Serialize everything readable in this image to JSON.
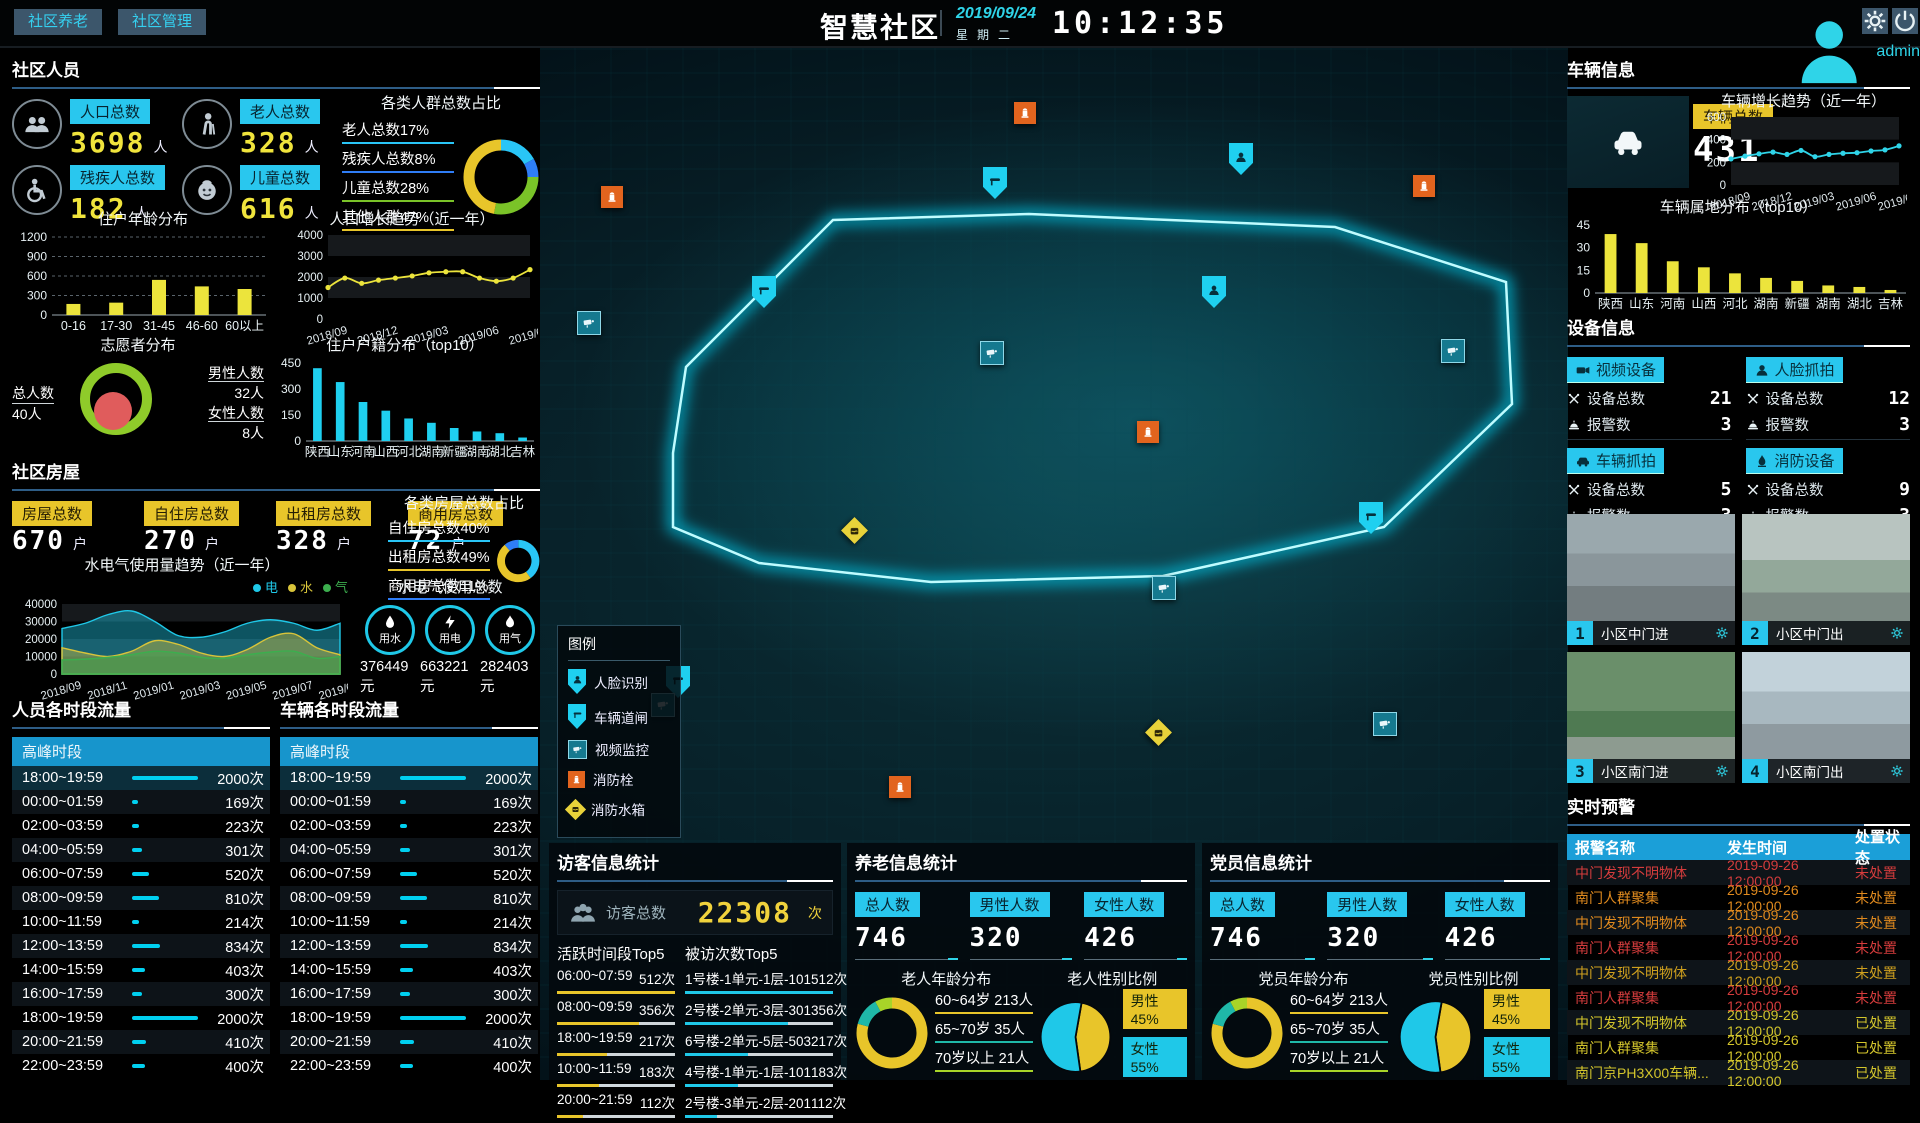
{
  "header": {
    "tabs": [
      {
        "label": "社区养老"
      },
      {
        "label": "社区管理"
      }
    ],
    "title": "智慧社区",
    "date": "2019/09/24",
    "weekday": "星期二",
    "time": "10:12:35",
    "user": "admin"
  },
  "accent": {
    "cyan": "#29c7ee",
    "yellow": "#e8c52a",
    "red": "#d43c3c",
    "orange": "#e08a1e"
  },
  "community_people": {
    "title": "社区人员",
    "unit": "人",
    "stats": [
      {
        "label": "人口总数",
        "value": "3698",
        "icon": "crowd"
      },
      {
        "label": "老人总数",
        "value": "328",
        "icon": "elder"
      },
      {
        "label": "残疾人总数",
        "value": "182",
        "icon": "wheelchair"
      },
      {
        "label": "儿童总数",
        "value": "616",
        "icon": "child"
      }
    ]
  },
  "house": {
    "title": "社区房屋",
    "unit": "户",
    "stats": [
      {
        "label": "房屋总数",
        "value": "670"
      },
      {
        "label": "自住房总数",
        "value": "270"
      },
      {
        "label": "出租房总数",
        "value": "328"
      },
      {
        "label": "商用房总数",
        "value": "72"
      }
    ],
    "util_total_title": "水电气使用总数",
    "util_totals": [
      {
        "label": "用水",
        "icon": "water",
        "value": "376449元"
      },
      {
        "label": "用电",
        "icon": "bolt",
        "value": "663221元"
      },
      {
        "label": "用气",
        "icon": "flame",
        "value": "282403元"
      }
    ]
  },
  "flows": {
    "people_title": "人员各时段流量",
    "vehicle_title": "车辆各时段流量",
    "header": "高峰时段",
    "unit": "次",
    "max": 2000,
    "rows": [
      {
        "time": "18:00~19:59",
        "count": 2000
      },
      {
        "time": "00:00~01:59",
        "count": 169
      },
      {
        "time": "02:00~03:59",
        "count": 223
      },
      {
        "time": "04:00~05:59",
        "count": 301
      },
      {
        "time": "06:00~07:59",
        "count": 520
      },
      {
        "time": "08:00~09:59",
        "count": 810
      },
      {
        "time": "10:00~11:59",
        "count": 214
      },
      {
        "time": "12:00~13:59",
        "count": 834
      },
      {
        "time": "14:00~15:59",
        "count": 403
      },
      {
        "time": "16:00~17:59",
        "count": 300
      },
      {
        "time": "18:00~19:59",
        "count": 2000
      },
      {
        "time": "20:00~21:59",
        "count": 410
      },
      {
        "time": "22:00~23:59",
        "count": 400
      }
    ]
  },
  "visitor": {
    "title": "访客信息统计",
    "total_label": "访客总数",
    "total_value": "22308",
    "total_unit": "次",
    "unit": "次",
    "active_title": "活跃时间段Top5",
    "active": [
      {
        "label": "06:00~07:59",
        "value": 512
      },
      {
        "label": "08:00~09:59",
        "value": 356
      },
      {
        "label": "18:00~19:59",
        "value": 217
      },
      {
        "label": "10:00~11:59",
        "value": 183
      },
      {
        "label": "20:00~21:59",
        "value": 112
      }
    ],
    "visited_title": "被访次数Top5",
    "visited": [
      {
        "label": "1号楼-1单元-1层-101",
        "value": 512
      },
      {
        "label": "2号楼-2单元-3层-301",
        "value": 356
      },
      {
        "label": "6号楼-2单元-5层-503",
        "value": 217
      },
      {
        "label": "4号楼-1单元-1层-101",
        "value": 183
      },
      {
        "label": "2号楼-3单元-2层-201",
        "value": 112
      }
    ]
  },
  "elderly": {
    "title": "养老信息统计",
    "stats": [
      {
        "label": "总人数",
        "value": "746"
      },
      {
        "label": "男性人数",
        "value": "320"
      },
      {
        "label": "女性人数",
        "value": "426"
      }
    ]
  },
  "party": {
    "title": "党员信息统计",
    "stats": [
      {
        "label": "总人数",
        "value": "746"
      },
      {
        "label": "男性人数",
        "value": "320"
      },
      {
        "label": "女性人数",
        "value": "426"
      }
    ]
  },
  "vehicle_info": {
    "title": "车辆信息",
    "badge": "车辆总数",
    "value": "431"
  },
  "devices": {
    "title": "设备信息",
    "total_label": "设备总数",
    "alarm_label": "报警数",
    "items": [
      {
        "label": "视频设备",
        "icon": "video",
        "total": "21",
        "alarms": "3"
      },
      {
        "label": "人脸抓拍",
        "icon": "faceb",
        "total": "12",
        "alarms": "3"
      },
      {
        "label": "车辆抓拍",
        "icon": "car",
        "total": "5",
        "alarms": "3"
      },
      {
        "label": "消防设备",
        "icon": "flame2",
        "total": "9",
        "alarms": "3"
      }
    ]
  },
  "cameras": {
    "items": [
      {
        "num": "1",
        "label": "小区中门进"
      },
      {
        "num": "2",
        "label": "小区中门出"
      },
      {
        "num": "3",
        "label": "小区南门进"
      },
      {
        "num": "4",
        "label": "小区南门出"
      }
    ]
  },
  "alerts": {
    "title": "实时预警",
    "headers": [
      "报警名称",
      "发生时间",
      "处置状态"
    ],
    "rows": [
      {
        "name": "中门发现不明物体",
        "time": "2019-09-26 12:00:00",
        "status": "未处置",
        "color": "#d43c3c"
      },
      {
        "name": "南门人群聚集",
        "time": "2019-09-26 12:00:00",
        "status": "未处置",
        "color": "#e08a1e"
      },
      {
        "name": "中门发现不明物体",
        "time": "2019-09-26 12:00:00",
        "status": "未处置",
        "color": "#e08a1e"
      },
      {
        "name": "南门人群聚集",
        "time": "2019-09-26 12:00:00",
        "status": "未处置",
        "color": "#d43c3c"
      },
      {
        "name": "中门发现不明物体",
        "time": "2019-09-26 12:00:00",
        "status": "未处置",
        "color": "#cfa01e"
      },
      {
        "name": "南门人群聚集",
        "time": "2019-09-26 12:00:00",
        "status": "未处置",
        "color": "#d43c3c"
      },
      {
        "name": "中门发现不明物体",
        "time": "2019-09-26 12:00:00",
        "status": "已处置",
        "color": "#d3c52c"
      },
      {
        "name": "南门人群聚集",
        "time": "2019-09-26 12:00:00",
        "status": "已处置",
        "color": "#d3c52c"
      },
      {
        "name": "南门京PH3X00车辆...",
        "time": "2019-09-26 12:00:00",
        "status": "已处置",
        "color": "#d3c52c"
      }
    ]
  },
  "map": {
    "legend_title": "图例",
    "legend": [
      {
        "type": "face",
        "label": "人脸识别"
      },
      {
        "type": "gate",
        "label": "车辆道闸"
      },
      {
        "type": "video",
        "label": "视频监控"
      },
      {
        "type": "hydrant",
        "label": "消防栓"
      },
      {
        "type": "tank",
        "label": "消防水箱"
      }
    ],
    "markers": [
      {
        "type": "hydrant",
        "x": 72,
        "y": 154
      },
      {
        "type": "video",
        "x": 48,
        "y": 279
      },
      {
        "type": "gate",
        "x": 223,
        "y": 244
      },
      {
        "type": "hydrant",
        "x": 485,
        "y": 70
      },
      {
        "type": "gate",
        "x": 454,
        "y": 135
      },
      {
        "type": "face",
        "x": 700,
        "y": 111
      },
      {
        "type": "hydrant",
        "x": 884,
        "y": 143
      },
      {
        "type": "face",
        "x": 673,
        "y": 244
      },
      {
        "type": "video",
        "x": 451,
        "y": 309
      },
      {
        "type": "video",
        "x": 912,
        "y": 307
      },
      {
        "type": "hydrant",
        "x": 608,
        "y": 389
      },
      {
        "type": "tank",
        "x": 316,
        "y": 489
      },
      {
        "type": "gate",
        "x": 830,
        "y": 470
      },
      {
        "type": "video",
        "x": 623,
        "y": 544
      },
      {
        "type": "gate",
        "x": 137,
        "y": 634
      },
      {
        "type": "video",
        "x": 122,
        "y": 661
      },
      {
        "type": "tank",
        "x": 620,
        "y": 691
      },
      {
        "type": "hydrant",
        "x": 360,
        "y": 744
      },
      {
        "type": "video",
        "x": 844,
        "y": 680
      }
    ],
    "boundary": "133,407 146,321 293,174 489,168 795,181 966,236 972,358 844,481 623,530 391,536 219,517 133,481"
  },
  "charts": {
    "crowd_ratio": {
      "type": "donut",
      "title": "各类人群总数占比",
      "items": [
        {
          "label": "老人总数17%",
          "value": 17,
          "color": "#29c5f6"
        },
        {
          "label": "残疾人总数8%",
          "value": 8,
          "color": "#2f7df6"
        },
        {
          "label": "儿童总数28%",
          "value": 28,
          "color": "#7ac328"
        },
        {
          "label": "其他人群47%",
          "value": 47,
          "color": "#e8c52a"
        }
      ]
    },
    "age_dist": {
      "type": "bar",
      "title": "住户年龄分布",
      "grid": "dash",
      "mL": 40,
      "categories": [
        "0-16",
        "17-30",
        "31-45",
        "46-60",
        "60以上"
      ],
      "values": [
        170,
        190,
        540,
        440,
        400
      ],
      "ticks": [
        0,
        300,
        600,
        900,
        1200
      ],
      "ymax": 1200,
      "color": "#ece43c"
    },
    "pop_growth": {
      "type": "line",
      "title": "人口增长趋势（近一年）",
      "mL": 44,
      "x_labels": [
        "2018/09",
        "",
        "",
        "2018/12",
        "",
        "",
        "2019/03",
        "",
        "",
        "2019/06",
        "",
        "",
        "2019/09"
      ],
      "values": [
        1500,
        1950,
        1700,
        1850,
        1950,
        2050,
        2200,
        2250,
        2250,
        1950,
        1800,
        1950,
        2350
      ],
      "ticks": [
        0,
        1000,
        2000,
        3000,
        4000
      ],
      "ymax": 4000,
      "color": "#ece43c"
    },
    "volunteer": {
      "type": "rings",
      "title": "志愿者分布",
      "total_label": "总人数",
      "total": "40人",
      "male_label": "男性人数",
      "male": "32人",
      "female_label": "女性人数",
      "female": "8人",
      "ring_color": "#8fcb2a",
      "inner_color": "#e05c5c"
    },
    "hukou": {
      "type": "bar",
      "title": "住户户籍分布（top10）",
      "mL": 36,
      "categories": [
        "陕西",
        "山东",
        "河南",
        "山西",
        "河北",
        "湖南",
        "新疆",
        "湖南",
        "湖北",
        "吉林"
      ],
      "values": [
        420,
        340,
        225,
        175,
        130,
        105,
        75,
        55,
        45,
        20
      ],
      "ticks": [
        0,
        150,
        300,
        450
      ],
      "ymax": 450,
      "color": "#1fd0f0"
    },
    "house_ratio": {
      "type": "donut",
      "title": "各类房屋总数占比",
      "items": [
        {
          "label": "自住房总数40%",
          "value": 40,
          "color": "#29c5f6"
        },
        {
          "label": "出租房总数49%",
          "value": 49,
          "color": "#e8c52a"
        },
        {
          "label": "商用房总数11%",
          "value": 11,
          "color": "#2f7df6"
        }
      ]
    },
    "utilities": {
      "type": "area",
      "title": "水电气使用量趋势（近一年）",
      "mL": 50,
      "x_labels": [
        "2018/09",
        "",
        "2018/11",
        "",
        "2019/01",
        "",
        "2019/03",
        "",
        "2019/05",
        "",
        "2019/07",
        "",
        "2019/09"
      ],
      "series": [
        {
          "name": "电",
          "color": "#1fc8e8",
          "values": [
            26000,
            29000,
            34000,
            36000,
            30000,
            22000,
            21000,
            24000,
            29000,
            31000,
            29000,
            25000,
            29000
          ]
        },
        {
          "name": "水",
          "color": "#d8c43a",
          "values": [
            15000,
            12000,
            10000,
            13000,
            19000,
            17000,
            12000,
            10000,
            14000,
            21000,
            23000,
            15000,
            11000
          ]
        },
        {
          "name": "气",
          "color": "#3cae4e",
          "values": [
            8000,
            8500,
            9500,
            11000,
            13000,
            12000,
            9500,
            9000,
            11000,
            12500,
            13000,
            9000,
            10000
          ]
        }
      ],
      "ticks": [
        0,
        10000,
        20000,
        30000,
        40000
      ],
      "ymax": 40000
    },
    "veh_growth": {
      "type": "line",
      "title": "车辆增长趋势（近一年）",
      "mL": 34,
      "x_labels": [
        "2018/09",
        "",
        "",
        "2018/12",
        "",
        "",
        "2019/03",
        "",
        "",
        "2019/06",
        "",
        "",
        "2019/09"
      ],
      "values": [
        230,
        255,
        275,
        290,
        270,
        305,
        250,
        270,
        280,
        285,
        300,
        310,
        345
      ],
      "ticks": [
        0,
        200,
        400,
        600
      ],
      "ymax": 600,
      "color": "#2fd4e8"
    },
    "veh_origin": {
      "type": "bar",
      "title": "车辆属地分布（top10）",
      "mL": 28,
      "categories": [
        "陕西",
        "山东",
        "河南",
        "山西",
        "河北",
        "湖南",
        "新疆",
        "湖南",
        "湖北",
        "吉林"
      ],
      "values": [
        39,
        33,
        21,
        17,
        13,
        10,
        8,
        5,
        4,
        2
      ],
      "ticks": [
        0,
        15,
        30,
        45
      ],
      "ymax": 45,
      "color": "#ece43c"
    },
    "elder_age": {
      "type": "donut",
      "title": "老人年龄分布",
      "items": [
        {
          "label": "60~64岁 213人",
          "value": 213,
          "color": "#e8c52a"
        },
        {
          "label": "65~70岁 35人",
          "value": 35,
          "color": "#1fb8a8"
        },
        {
          "label": "70岁以上 21人",
          "value": 21,
          "color": "#a8d428"
        }
      ]
    },
    "elder_gender": {
      "type": "pie",
      "title": "老人性别比例",
      "items": [
        {
          "label": "男性45%",
          "value": 45,
          "color": "#e8c52a"
        },
        {
          "label": "女性55%",
          "value": 55,
          "color": "#1fc8e8"
        }
      ]
    },
    "party_age": {
      "type": "donut",
      "title": "党员年龄分布",
      "items": [
        {
          "label": "60~64岁 213人",
          "value": 213,
          "color": "#e8c52a"
        },
        {
          "label": "65~70岁 35人",
          "value": 35,
          "color": "#1fb8a8"
        },
        {
          "label": "70岁以上 21人",
          "value": 21,
          "color": "#a8d428"
        }
      ]
    },
    "party_gender": {
      "type": "pie",
      "title": "党员性别比例",
      "items": [
        {
          "label": "男性45%",
          "value": 45,
          "color": "#e8c52a"
        },
        {
          "label": "女性55%",
          "value": 55,
          "color": "#1fc8e8"
        }
      ]
    }
  }
}
